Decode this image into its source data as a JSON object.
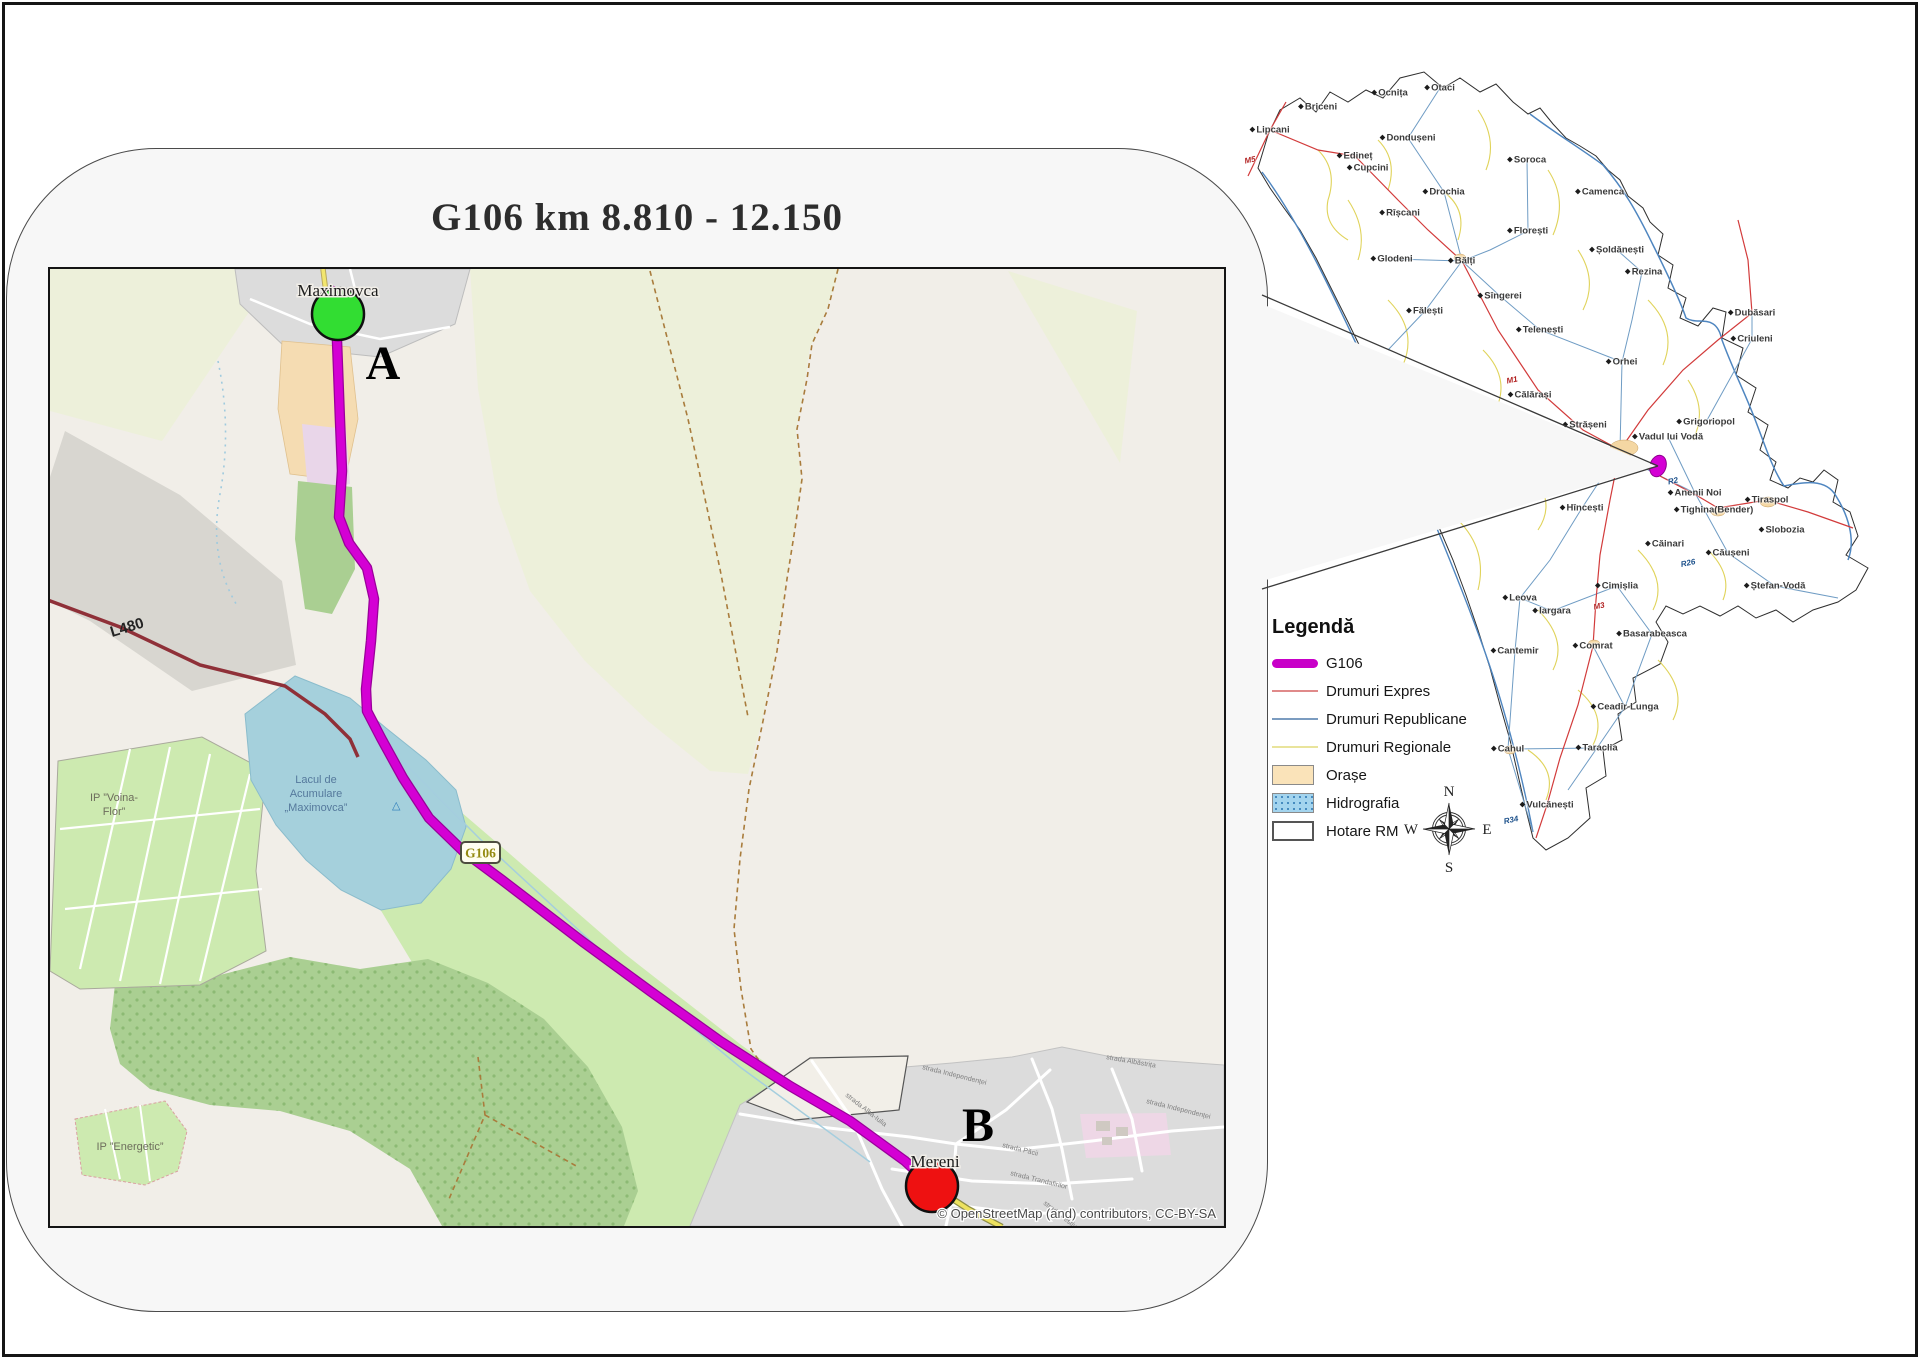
{
  "title": "G106 km 8.810 - 12.150",
  "main_map": {
    "place_labels": {
      "maximovca": "Maximovca",
      "mereni": "Mereni",
      "point_a": "A",
      "point_b": "B"
    },
    "lake_label_lines": [
      "Lacul de",
      "Acumulare",
      "„Maximovca”"
    ],
    "area_labels": {
      "voina_flor_1": "IP ”Voina-",
      "voina_flor_2": "Flor”",
      "energetic": "IP ”Energetic”"
    },
    "road_labels": {
      "l480": "L480",
      "g106_shield": "G106"
    },
    "street_labels": [
      "strada Alba-Iulia",
      "strada Independenței",
      "strada Păcii",
      "strada Trandafirilor",
      "strada Festivalului",
      "strada Albăstrița"
    ],
    "poi": {
      "camp_icon": "△"
    },
    "attribution": "© OpenStreetMap (and) contributors, CC-BY-SA"
  },
  "legend": {
    "title": "Legendă",
    "items": [
      {
        "label": "G106",
        "swatch": "thick-line",
        "color": "#c800c8"
      },
      {
        "label": "Drumuri Expres",
        "swatch": "line",
        "color": "#e08a8a"
      },
      {
        "label": "Drumuri Republicane",
        "swatch": "line",
        "color": "#7b9cc0"
      },
      {
        "label": "Drumuri Regionale",
        "swatch": "line",
        "color": "#e9e49c"
      },
      {
        "label": "Orașe",
        "swatch": "box",
        "color": "#fae3b9"
      },
      {
        "label": "Hidrografia",
        "swatch": "box-dots",
        "color": "#a3d4ee"
      },
      {
        "label": "Hotare RM",
        "swatch": "box",
        "color": "#ffffff"
      }
    ]
  },
  "compass": {
    "north": "N",
    "east": "E",
    "south": "S",
    "west": "W"
  },
  "overview": {
    "cities": [
      {
        "name": "Lipcani",
        "x": 42,
        "y": 80
      },
      {
        "name": "Briceni",
        "x": 90,
        "y": 57
      },
      {
        "name": "Ocnița",
        "x": 162,
        "y": 43
      },
      {
        "name": "Otaci",
        "x": 212,
        "y": 38
      },
      {
        "name": "Dondușeni",
        "x": 180,
        "y": 88
      },
      {
        "name": "Edineț",
        "x": 127,
        "y": 106
      },
      {
        "name": "Cupcini",
        "x": 140,
        "y": 118
      },
      {
        "name": "Soroca",
        "x": 299,
        "y": 110
      },
      {
        "name": "Drochia",
        "x": 216,
        "y": 142
      },
      {
        "name": "Camenca",
        "x": 372,
        "y": 142
      },
      {
        "name": "Rîșcani",
        "x": 172,
        "y": 163
      },
      {
        "name": "Florești",
        "x": 300,
        "y": 181
      },
      {
        "name": "Șoldănești",
        "x": 389,
        "y": 200
      },
      {
        "name": "Rezina",
        "x": 416,
        "y": 222
      },
      {
        "name": "Glodeni",
        "x": 164,
        "y": 209
      },
      {
        "name": "Bălți",
        "x": 234,
        "y": 211
      },
      {
        "name": "Sîngerei",
        "x": 272,
        "y": 246
      },
      {
        "name": "Fălești",
        "x": 197,
        "y": 261
      },
      {
        "name": "Telenești",
        "x": 312,
        "y": 280
      },
      {
        "name": "Orhei",
        "x": 394,
        "y": 312
      },
      {
        "name": "Călărași",
        "x": 302,
        "y": 345
      },
      {
        "name": "Strășeni",
        "x": 357,
        "y": 375
      },
      {
        "name": "Dubăsari",
        "x": 524,
        "y": 263
      },
      {
        "name": "Criuleni",
        "x": 524,
        "y": 289
      },
      {
        "name": "Grigoriopol",
        "x": 478,
        "y": 372
      },
      {
        "name": "Vadul lui Vodă",
        "x": 440,
        "y": 387
      },
      {
        "name": "Anenii Noi",
        "x": 467,
        "y": 443
      },
      {
        "name": "Hîncești",
        "x": 354,
        "y": 458
      },
      {
        "name": "Tighina(Bender)",
        "x": 486,
        "y": 460
      },
      {
        "name": "Tiraspol",
        "x": 539,
        "y": 450
      },
      {
        "name": "Slobozia",
        "x": 554,
        "y": 480
      },
      {
        "name": "Căinari",
        "x": 437,
        "y": 494
      },
      {
        "name": "Căușeni",
        "x": 500,
        "y": 503
      },
      {
        "name": "Cimișlia",
        "x": 389,
        "y": 536
      },
      {
        "name": "Ștefan-Vodă",
        "x": 547,
        "y": 536
      },
      {
        "name": "Leova",
        "x": 292,
        "y": 548
      },
      {
        "name": "Iargara",
        "x": 324,
        "y": 561
      },
      {
        "name": "Basarabeasca",
        "x": 424,
        "y": 584
      },
      {
        "name": "Cantemir",
        "x": 287,
        "y": 601
      },
      {
        "name": "Comrat",
        "x": 365,
        "y": 596
      },
      {
        "name": "Ceadîr-Lunga",
        "x": 397,
        "y": 657
      },
      {
        "name": "Taraclia",
        "x": 369,
        "y": 698
      },
      {
        "name": "Cahul",
        "x": 280,
        "y": 699
      },
      {
        "name": "Vulcănești",
        "x": 319,
        "y": 755
      }
    ],
    "road_labels": [
      {
        "name": "M5",
        "x": 22,
        "y": 110,
        "color": "#b22222"
      },
      {
        "name": "M1",
        "x": 284,
        "y": 330,
        "color": "#b22222"
      },
      {
        "name": "M3",
        "x": 371,
        "y": 556,
        "color": "#b22222"
      },
      {
        "name": "R2",
        "x": 445,
        "y": 431,
        "color": "#1a4f8a"
      },
      {
        "name": "R26",
        "x": 460,
        "y": 513,
        "color": "#1a4f8a"
      },
      {
        "name": "R34",
        "x": 283,
        "y": 770,
        "color": "#1a4f8a"
      }
    ]
  }
}
